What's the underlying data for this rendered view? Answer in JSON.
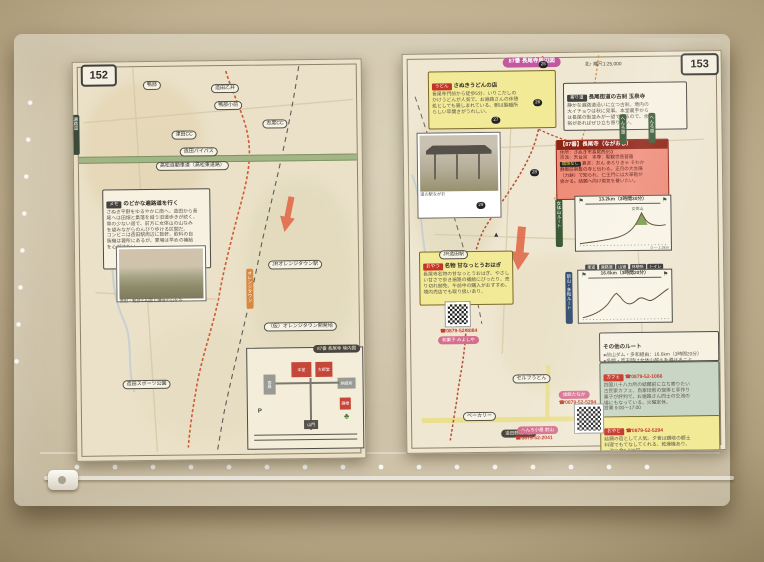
{
  "scene": {
    "description": "Photograph of a Shikoku pilgrimage guidebook spread (pages 152–153, route to temple 87 Nagao-ji) inside a clear zip document sleeve on a beige wall",
    "colors": {
      "wall": "#bcab8a",
      "paper_left": "#eae1c8",
      "paper_right": "#efe7d2",
      "henro_route": "#b5503a",
      "expressway_green": "#a3b585",
      "road_yellow": "#e9df8e",
      "highlight_yellow": "#f2ea96",
      "temple_red": "#ef8d7a",
      "temple_red_dark": "#8e2416",
      "pink_badge": "#d56f8d",
      "magenta_badge": "#c2589e",
      "teal_box": "#c9d6c5"
    }
  },
  "left_page": {
    "page_number": "152",
    "edge_tab": "遍路道",
    "expressway_label": "高松自動車道（高松東道路）",
    "vertical_label": "オレンジタウン",
    "map_labels": [
      "鴨部",
      "造田乙井",
      "鴨部小前",
      "津田CC",
      "志度CC",
      "造田バイパス",
      "JRオレンジタウン駅",
      "（仮）オレンジタウン開発地",
      "造田スポーツ公園"
    ],
    "info_box": {
      "chip": "メモ",
      "title": "のどかな遍路道を行く",
      "lines": [
        "さぬき平野をゆるやかに南へ。造田から長",
        "尾へは田畑と集落を縫う旧道歩きが続く。",
        "車の少ない道で、前方に女体山の山なみ",
        "を望みながらのんびり歩ける区間だ。",
        "コンビニは造田駅周辺に数軒。飲料の自",
        "販機は要所にあるが、夏場は早めの補給",
        "を心がけたい。"
      ]
    },
    "photo_caption": "造田・鴨部の田園と讃岐の山なみ",
    "precinct": {
      "tab": "87番 長尾寺 境内図",
      "main_hall": "本堂",
      "daishi_hall": "大師堂",
      "guest": "客殿",
      "office": "納経所",
      "bell": "鐘楼",
      "gate": "山門",
      "parking": "P",
      "tree": "♣"
    }
  },
  "right_page": {
    "page_number": "153",
    "header_badge": "87番 長尾寺周辺図",
    "header_note": "北↑ 縮尺1:25,000",
    "henro_pill": "へんろ道",
    "mountain_mark": "▲",
    "photo_caption": "道の駅ながお",
    "map_labels": [
      "JR造田駅",
      "セルフうどん",
      "ベーカリー",
      "造田郵便局前"
    ],
    "markers": [
      "25",
      "26",
      "27",
      "28",
      "29"
    ],
    "legend": [
      "車道",
      "遍路道",
      "山道",
      "休憩所",
      "トイレ"
    ],
    "boxes": {
      "udon": {
        "chip": "うどん",
        "title": "さぬきうどんの店",
        "lines": [
          "長尾寺門前から徒歩5分。いりこだしの",
          "かけうどんが人気で、お遍路さんの休憩",
          "処としても親しまれている。朝は製麺所",
          "らしい早開きがうれしい。"
        ]
      },
      "detour": {
        "chip": "寄り道",
        "title": "長尾街道の古刹 玉泉寺",
        "lines": [
          "静かな遍路道沿いに立つ古刹。境内の",
          "大イチョウは秋に見事。本堂裏手から",
          "は長尾の街並みが一望できるので、余",
          "裕があればぜひ立ち寄りたい。"
        ]
      },
      "temple": {
        "header": "【87番】長尾寺（ながおじ）",
        "rows": [
          "住所：さぬき市長尾西653",
          "宗派：天台宗　本尊：聖観世音菩薩",
          "真言：おん あろりきゃ そわか"
        ],
        "chip": "宿坊なし",
        "notes": [
          "静御前剃髪の寺と伝わる。正月の大会陽",
          "（力餅）で知られ、仁王門には大草鞋が",
          "掛かる。結願へ向け英気を養いたい。"
        ]
      },
      "snack": {
        "chip": "おやつ",
        "title": "名物 甘なっとうおはぎ",
        "lines": [
          "長尾寺名物の甘なっとうおはぎ。やさし",
          "い甘さで歩き遍路の補給にぴったり。売",
          "り切れ御免、午前中の購入がおすすめ。",
          "境内売店でも取り扱いあり。"
        ],
        "phone": "☎0879-52-3084",
        "badge": "和菓子 みよしや"
      },
      "other_routes": {
        "title": "その他のルート",
        "lines": [
          "●前山ダム・多和経由：16.6km（3時間20分）",
          "●冬期・荒天時は女体山越えを避けること"
        ]
      },
      "cafe": {
        "chip": "カフェ",
        "phone": "☎0879-52-1066",
        "lines": [
          "四国八十八カ所の結願前に立ち寄りたい",
          "古民家カフェ。自家焙煎の珈琲と手作り",
          "菓子が評判で、お遍路さん同士の交流の",
          "場にもなっている。火曜定休。",
          "営業 9:00〜17:00"
        ]
      },
      "yado": {
        "chip": "おやど",
        "phone": "☎0879-52-5294",
        "lines": [
          "結願の宿として人気。夕食は讃岐の郷土",
          "料理でもてなしてくれる。乾燥機あり。",
          "一泊二食6,500円。"
        ]
      }
    },
    "phone_badges": {
      "inn": {
        "name": "旅館たなか",
        "phone": "☎0879-52-5294"
      },
      "hut": {
        "name": "へんろ小屋 前山",
        "phone": "☎0879-52-2041"
      }
    }
  },
  "chart_data": [
    {
      "type": "area",
      "title": "87番長尾寺 → 88番大窪寺（女体山越えルート）",
      "side_label": "女体山ルート",
      "distance_label": "13.2km（3時間30分）",
      "x_km": [
        0,
        2,
        4,
        6,
        8,
        9.5,
        10.5,
        11.5,
        12.4,
        13.2
      ],
      "elevation_m": [
        40,
        60,
        90,
        140,
        230,
        390,
        774,
        700,
        560,
        450
      ],
      "peak_label": "女体山",
      "scale_note": "0 ― 1.0km",
      "start_flag": "⚑",
      "goal_flag": "⚑"
    },
    {
      "type": "area",
      "title": "87番長尾寺 → 88番大窪寺（前山ダム・多和経由）",
      "side_label": "前山・多和ルート",
      "distance_label": "16.6km（3時間20分）",
      "x_km": [
        0,
        2,
        4,
        6,
        7.5,
        9,
        10.5,
        12,
        13.5,
        15,
        16.6
      ],
      "elevation_m": [
        40,
        60,
        110,
        230,
        380,
        300,
        330,
        280,
        330,
        420,
        450
      ],
      "start_flag": "⚑",
      "goal_flag": "⚑"
    }
  ]
}
